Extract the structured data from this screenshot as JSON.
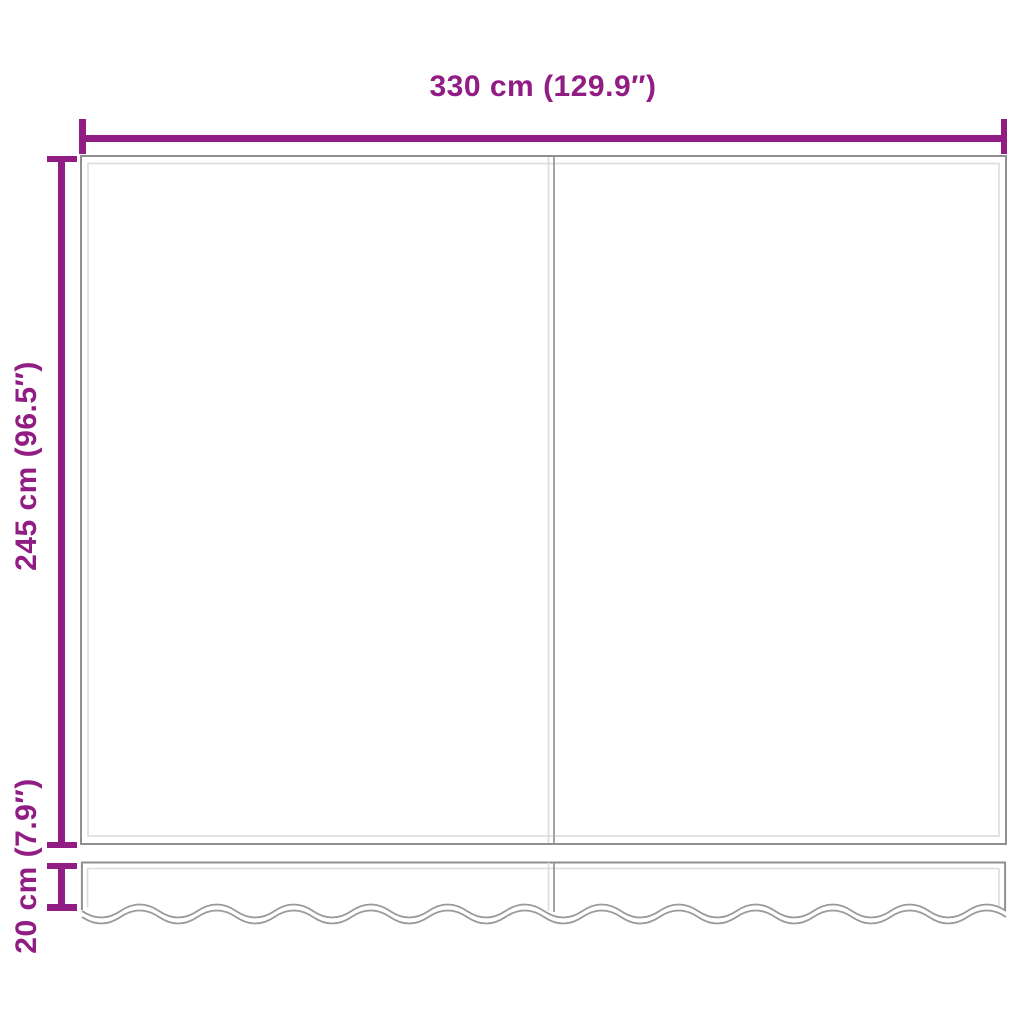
{
  "dimensions": {
    "width": {
      "label": "330 cm (129.9″)"
    },
    "height": {
      "label": "245 cm (96.5″)"
    },
    "valance_height": {
      "label": "20 cm (7.9″)"
    }
  },
  "colors": {
    "accent": "#911c83",
    "line_dark": "#8f8f8f",
    "line_mid": "#9a9a9a",
    "line_light": "#dcdcdc",
    "background": "#ffffff"
  }
}
